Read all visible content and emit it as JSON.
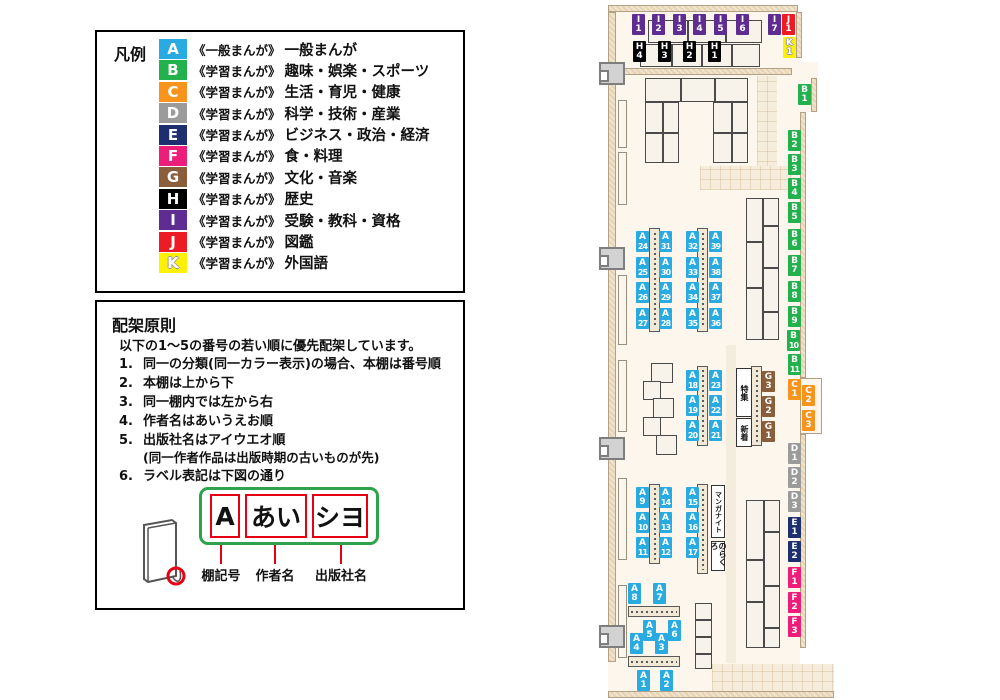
{
  "legend": {
    "title": "凡例",
    "items": [
      {
        "code": "A",
        "prefix": "《一般まんが》",
        "label": "一般まんが"
      },
      {
        "code": "B",
        "prefix": "《学習まんが》",
        "label": "趣味・娯楽・スポーツ"
      },
      {
        "code": "C",
        "prefix": "《学習まんが》",
        "label": "生活・育児・健康"
      },
      {
        "code": "D",
        "prefix": "《学習まんが》",
        "label": "科学・技術・産業"
      },
      {
        "code": "E",
        "prefix": "《学習まんが》",
        "label": "ビジネス・政治・経済"
      },
      {
        "code": "F",
        "prefix": "《学習まんが》",
        "label": "食・料理"
      },
      {
        "code": "G",
        "prefix": "《学習まんが》",
        "label": "文化・音楽"
      },
      {
        "code": "H",
        "prefix": "《学習まんが》",
        "label": "歴史"
      },
      {
        "code": "I",
        "prefix": "《学習まんが》",
        "label": "受験・教科・資格"
      },
      {
        "code": "J",
        "prefix": "《学習まんが》",
        "label": "図鑑"
      },
      {
        "code": "K",
        "prefix": "《学習まんが》",
        "label": "外国語"
      }
    ]
  },
  "principles": {
    "title": "配架原則",
    "intro": "以下の1〜5の番号の若い順に優先配架しています。",
    "items": [
      {
        "num": "1.",
        "text": "同一の分類(同一カラー表示)の場合、本棚は番号順"
      },
      {
        "num": "2.",
        "text": "本棚は上から下"
      },
      {
        "num": "3.",
        "text": "同一棚内では左から右"
      },
      {
        "num": "4.",
        "text": "作者名はあいうえお順"
      },
      {
        "num": "5.",
        "text": "出版社名はアイウエオ順",
        "note": "(同一作者作品は出版時期の古いものが先)"
      },
      {
        "num": "6.",
        "text": "ラベル表記は下図の通り"
      }
    ],
    "diagram": {
      "boxes": [
        "A",
        "あい",
        "シヨ"
      ],
      "captions": [
        "棚記号",
        "作者名",
        "出版社名"
      ]
    }
  },
  "map": {
    "category_colors": {
      "A": "#29abe2",
      "B": "#22b14c",
      "C": "#f7941d",
      "D": "#9b9b9b",
      "E": "#1d2f6f",
      "F": "#ed1e79",
      "G": "#8a5d3b",
      "H": "#000000",
      "I": "#5f2d91",
      "J": "#ed1c24",
      "K": "#fff100"
    },
    "shelf_labels": [
      {
        "code": "I1",
        "x": 632,
        "y": 14
      },
      {
        "code": "I2",
        "x": 652,
        "y": 14
      },
      {
        "code": "I3",
        "x": 673,
        "y": 14
      },
      {
        "code": "I4",
        "x": 693,
        "y": 14
      },
      {
        "code": "I5",
        "x": 714,
        "y": 14
      },
      {
        "code": "I6",
        "x": 736,
        "y": 14
      },
      {
        "code": "I7",
        "x": 768,
        "y": 14
      },
      {
        "code": "J1",
        "x": 782,
        "y": 14
      },
      {
        "code": "K1",
        "x": 783,
        "y": 37
      },
      {
        "code": "H4",
        "x": 633,
        "y": 41
      },
      {
        "code": "H3",
        "x": 658,
        "y": 41
      },
      {
        "code": "H2",
        "x": 683,
        "y": 41
      },
      {
        "code": "H1",
        "x": 708,
        "y": 41
      },
      {
        "code": "B1",
        "x": 798,
        "y": 84
      },
      {
        "code": "B2",
        "x": 788,
        "y": 130
      },
      {
        "code": "B3",
        "x": 788,
        "y": 154
      },
      {
        "code": "B4",
        "x": 788,
        "y": 178
      },
      {
        "code": "B5",
        "x": 788,
        "y": 202
      },
      {
        "code": "B6",
        "x": 788,
        "y": 229
      },
      {
        "code": "B7",
        "x": 788,
        "y": 255
      },
      {
        "code": "B8",
        "x": 788,
        "y": 281
      },
      {
        "code": "B9",
        "x": 788,
        "y": 306
      },
      {
        "code": "B10",
        "x": 787,
        "y": 330
      },
      {
        "code": "B11",
        "x": 788,
        "y": 354
      },
      {
        "code": "C1",
        "x": 788,
        "y": 379
      },
      {
        "code": "C2",
        "x": 802,
        "y": 385
      },
      {
        "code": "C3",
        "x": 802,
        "y": 410
      },
      {
        "code": "G3",
        "x": 762,
        "y": 371
      },
      {
        "code": "G2",
        "x": 762,
        "y": 396
      },
      {
        "code": "G1",
        "x": 762,
        "y": 421
      },
      {
        "code": "D1",
        "x": 788,
        "y": 443
      },
      {
        "code": "D2",
        "x": 788,
        "y": 467
      },
      {
        "code": "D3",
        "x": 788,
        "y": 491
      },
      {
        "code": "E1",
        "x": 788,
        "y": 517
      },
      {
        "code": "E2",
        "x": 788,
        "y": 541
      },
      {
        "code": "F1",
        "x": 788,
        "y": 567
      },
      {
        "code": "F2",
        "x": 788,
        "y": 592
      },
      {
        "code": "F3",
        "x": 788,
        "y": 616
      },
      {
        "code": "A24",
        "x": 636,
        "y": 231
      },
      {
        "code": "A25",
        "x": 636,
        "y": 257
      },
      {
        "code": "A26",
        "x": 636,
        "y": 282
      },
      {
        "code": "A27",
        "x": 636,
        "y": 308
      },
      {
        "code": "A31",
        "x": 659,
        "y": 231
      },
      {
        "code": "A30",
        "x": 659,
        "y": 257
      },
      {
        "code": "A29",
        "x": 659,
        "y": 282
      },
      {
        "code": "A28",
        "x": 659,
        "y": 308
      },
      {
        "code": "A32",
        "x": 686,
        "y": 231
      },
      {
        "code": "A33",
        "x": 686,
        "y": 257
      },
      {
        "code": "A34",
        "x": 686,
        "y": 282
      },
      {
        "code": "A35",
        "x": 686,
        "y": 308
      },
      {
        "code": "A39",
        "x": 709,
        "y": 231
      },
      {
        "code": "A38",
        "x": 709,
        "y": 257
      },
      {
        "code": "A37",
        "x": 709,
        "y": 282
      },
      {
        "code": "A36",
        "x": 709,
        "y": 308
      },
      {
        "code": "A18",
        "x": 686,
        "y": 370
      },
      {
        "code": "A19",
        "x": 686,
        "y": 395
      },
      {
        "code": "A20",
        "x": 686,
        "y": 420
      },
      {
        "code": "A23",
        "x": 709,
        "y": 370
      },
      {
        "code": "A22",
        "x": 709,
        "y": 395
      },
      {
        "code": "A21",
        "x": 709,
        "y": 420
      },
      {
        "code": "A9",
        "x": 636,
        "y": 487
      },
      {
        "code": "A10",
        "x": 636,
        "y": 512
      },
      {
        "code": "A11",
        "x": 636,
        "y": 537
      },
      {
        "code": "A14",
        "x": 659,
        "y": 487
      },
      {
        "code": "A13",
        "x": 659,
        "y": 512
      },
      {
        "code": "A12",
        "x": 659,
        "y": 537
      },
      {
        "code": "A15",
        "x": 686,
        "y": 487
      },
      {
        "code": "A16",
        "x": 686,
        "y": 512
      },
      {
        "code": "A17",
        "x": 686,
        "y": 537
      },
      {
        "code": "A8",
        "x": 628,
        "y": 583
      },
      {
        "code": "A7",
        "x": 653,
        "y": 583
      },
      {
        "code": "A5",
        "x": 643,
        "y": 620
      },
      {
        "code": "A6",
        "x": 668,
        "y": 620
      },
      {
        "code": "A4",
        "x": 630,
        "y": 633
      },
      {
        "code": "A3",
        "x": 655,
        "y": 633
      },
      {
        "code": "A1",
        "x": 637,
        "y": 670
      },
      {
        "code": "A2",
        "x": 660,
        "y": 670
      }
    ],
    "special_labels": [
      {
        "id": "tokushu",
        "text": "特集",
        "x": 736,
        "y": 368,
        "w": 16,
        "h": 49
      },
      {
        "id": "shinchaku",
        "text": "新着",
        "x": 736,
        "y": 418,
        "w": 16,
        "h": 29
      },
      {
        "id": "manga-night",
        "text": "マンガナイト",
        "x": 711,
        "y": 485,
        "w": 14,
        "h": 53
      },
      {
        "id": "norakuro",
        "text": "のらくろ",
        "x": 711,
        "y": 541,
        "w": 14,
        "h": 30
      }
    ]
  }
}
